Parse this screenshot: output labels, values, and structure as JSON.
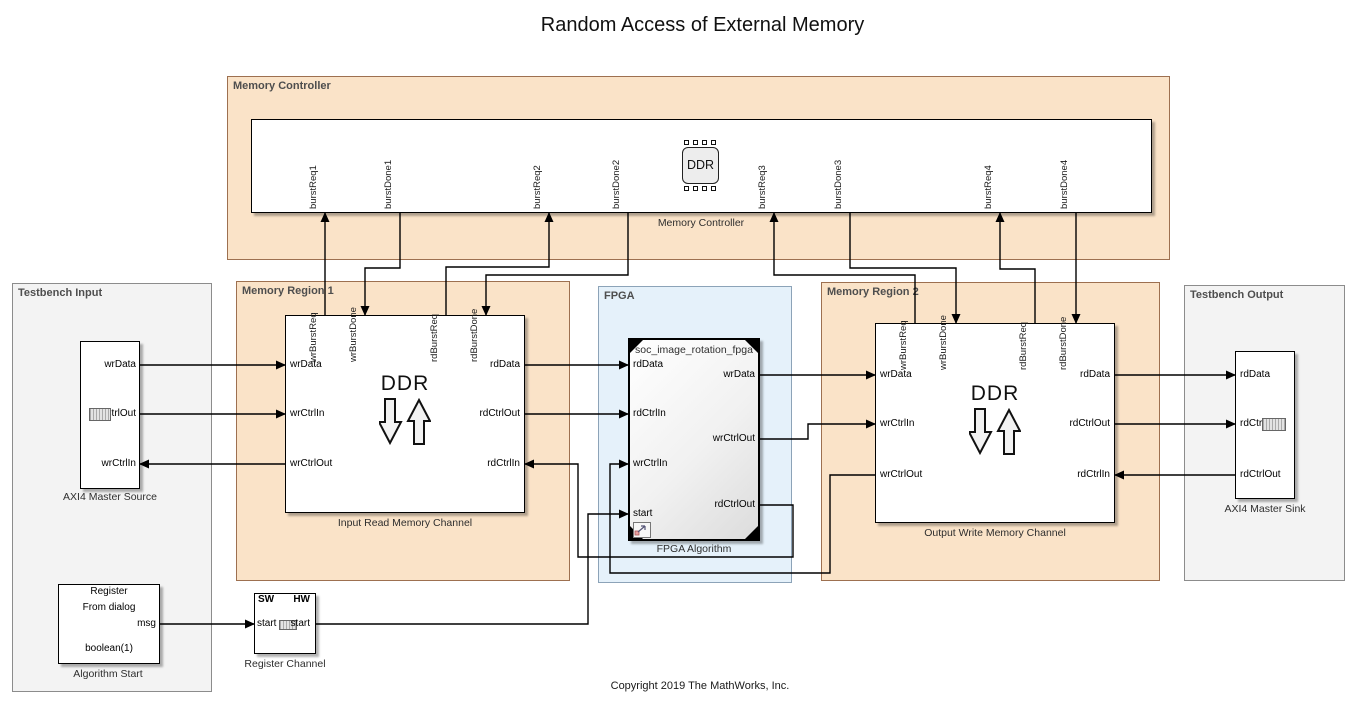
{
  "title": "Random Access of External Memory",
  "copyright": "Copyright 2019 The MathWorks, Inc.",
  "colors": {
    "region_orange": "#FAE3C8",
    "region_orange_border": "#9d7050",
    "region_gray": "#F3F3F3",
    "region_blue": "#E5F1FA",
    "block_background": "#FFFFFF",
    "wire": "#000000"
  },
  "regions": {
    "memory_controller": {
      "label": "Memory Controller"
    },
    "testbench_input": {
      "label": "Testbench Input"
    },
    "memory_region_1": {
      "label": "Memory Region 1"
    },
    "fpga": {
      "label": "FPGA"
    },
    "memory_region_2": {
      "label": "Memory Region 2"
    },
    "testbench_output": {
      "label": "Testbench Output"
    }
  },
  "blocks": {
    "memory_controller": {
      "name": "Memory Controller",
      "chip_label": "DDR",
      "ports": [
        "burstReq1",
        "burstDone1",
        "burstReq2",
        "burstDone2",
        "burstReq3",
        "burstDone3",
        "burstReq4",
        "burstDone4"
      ]
    },
    "axi4_master_source": {
      "name": "AXI4 Master Source",
      "ports": [
        "wrData",
        "wrCtrlOut",
        "wrCtrlIn"
      ]
    },
    "input_read_memory_channel": {
      "name": "Input Read Memory Channel",
      "center_label": "DDR",
      "top_ports": [
        "wrBurstReq",
        "wrBurstDone",
        "rdBurstReq",
        "rdBurstDone"
      ],
      "left_ports": [
        "wrData",
        "wrCtrlIn",
        "wrCtrlOut"
      ],
      "right_ports": [
        "rdData",
        "rdCtrlOut",
        "rdCtrlIn"
      ]
    },
    "fpga_algorithm": {
      "name": "FPGA Algorithm",
      "title": "soc_image_rotation_fpga",
      "left_ports": [
        "rdData",
        "rdCtrlIn",
        "wrCtrlIn",
        "start"
      ],
      "right_ports": [
        "wrData",
        "wrCtrlOut",
        "rdCtrlOut"
      ]
    },
    "output_write_memory_channel": {
      "name": "Output Write Memory Channel",
      "center_label": "DDR",
      "top_ports": [
        "wrBurstReq",
        "wrBurstDone",
        "rdBurstReq",
        "rdBurstDone"
      ],
      "left_ports": [
        "wrData",
        "wrCtrlIn",
        "wrCtrlOut"
      ],
      "right_ports": [
        "rdData",
        "rdCtrlOut",
        "rdCtrlIn"
      ]
    },
    "axi4_master_sink": {
      "name": "AXI4 Master Sink",
      "ports": [
        "rdData",
        "rdCtrlIn",
        "rdCtrlOut"
      ]
    },
    "algorithm_start": {
      "name": "Algorithm Start",
      "line1": "Register",
      "line2": "From dialog",
      "out_port": "msg",
      "value": "boolean(1)"
    },
    "register_channel": {
      "name": "Register Channel",
      "sw_label": "SW",
      "hw_label": "HW",
      "in_port": "start",
      "out_port": "start"
    }
  }
}
